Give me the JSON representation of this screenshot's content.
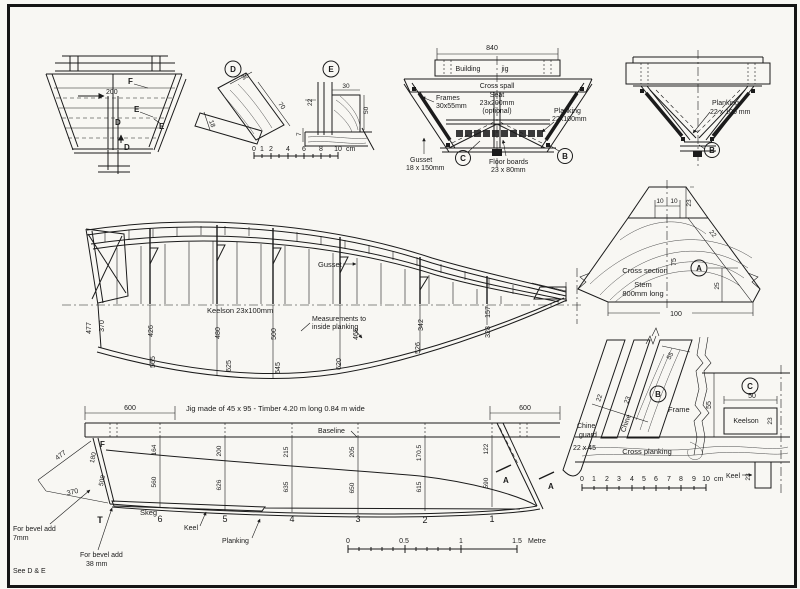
{
  "transom_view": {
    "dim_200": "200",
    "label_f": "F",
    "label_e1": "E",
    "label_e2": "E",
    "label_d1": "D",
    "label_d2": "D"
  },
  "detail_d": {
    "badge": "D",
    "dim_top": "30",
    "dim_side": "70",
    "dim_bottom": "18"
  },
  "detail_e": {
    "badge": "E",
    "dim_top": "30",
    "dim_left": "22",
    "dim_right": "50",
    "dim_bottom": "7"
  },
  "cm_scale_small": {
    "ticks": [
      "0",
      "1",
      "2",
      "4",
      "6",
      "8",
      "10"
    ],
    "unit": "cm"
  },
  "midship_section": {
    "dim_840": "840",
    "building": "Building",
    "jig": "jig",
    "cross_spall": "Cross spall",
    "frames1": "Frames",
    "frames2": "30x55mm",
    "seat1": "Seat",
    "seat2": "23x200mm",
    "seat3": "(optional)",
    "planking1": "Planking",
    "planking2": "22x100mm",
    "gusset1": "Gusset",
    "gusset2": "18 x 150mm",
    "floor1": "Floor boards",
    "floor2": "23 x 80mm",
    "badge_c": "C",
    "badge_b": "B"
  },
  "bow_section": {
    "planking1": "Planking",
    "planking2": "22 x 100 mm",
    "badge_b": "B"
  },
  "profile": {
    "gusset": "Gusset",
    "keelson": "Keelson  23x100mm",
    "meas1": "Measurements to",
    "meas2": "inside planking",
    "upper": [
      "477",
      "370",
      "426",
      "480",
      "500",
      "465",
      "342",
      "157"
    ],
    "lower": [
      "565",
      "625",
      "645",
      "620",
      "526",
      "328"
    ]
  },
  "stem_section": {
    "dim_10a": "10",
    "dim_10b": "10",
    "dim_23": "23",
    "dim_22": "22",
    "dim_75": "75",
    "dim_25": "25",
    "dim_100": "100",
    "title": "Cross section",
    "stem": "Stem",
    "stem_len": "800mm long",
    "badge_a": "A"
  },
  "chine_detail": {
    "dim_55_diag": "55",
    "dim_22": "22",
    "dim_23": "23",
    "badge_b": "B",
    "frame": "Frame",
    "chine": "Chine",
    "guard1": "Chine",
    "guard2": "guard",
    "guard_size": "22 x 45",
    "cross_planking": "Cross planking",
    "dim_55_vert": "55",
    "badge_c": "C",
    "dim_50": "50",
    "keelson": "Keelson",
    "keelson_23": "23",
    "keel": "Keel",
    "keel_23": "23",
    "scale": [
      "0",
      "1",
      "2",
      "3",
      "4",
      "5",
      "6",
      "7",
      "8",
      "9",
      "10"
    ],
    "scale_unit": "cm"
  },
  "plan": {
    "dim_600_left": "600",
    "dim_600_right": "600",
    "jig_text": "Jig made of 45 x 95 - Timber  4.20 m long  0.84 m wide",
    "baseline": "Baseline",
    "label_f": "F",
    "dim_180": "180",
    "dim_508": "508",
    "dim_477": "477",
    "dim_370": "370",
    "skeg": "Skeg",
    "keel": "Keel",
    "planking": "Planking",
    "stations": [
      "T",
      "6",
      "5",
      "4",
      "3",
      "2",
      "1"
    ],
    "upper": [
      "164",
      "200",
      "215",
      "205",
      "170.5",
      "122"
    ],
    "lower": [
      "560",
      "626",
      "635",
      "650",
      "615",
      "590"
    ],
    "label_a1": "A",
    "label_a2": "A"
  },
  "metre_scale": {
    "t0": "0",
    "t05": "0.5",
    "t1": "1",
    "t15": "1.5",
    "unit": "Metre"
  },
  "notes": {
    "bevel1a": "For bevel add",
    "bevel1b": "7mm",
    "bevel2a": "For bevel add",
    "bevel2b": "38 mm",
    "see": "See  D & E"
  }
}
